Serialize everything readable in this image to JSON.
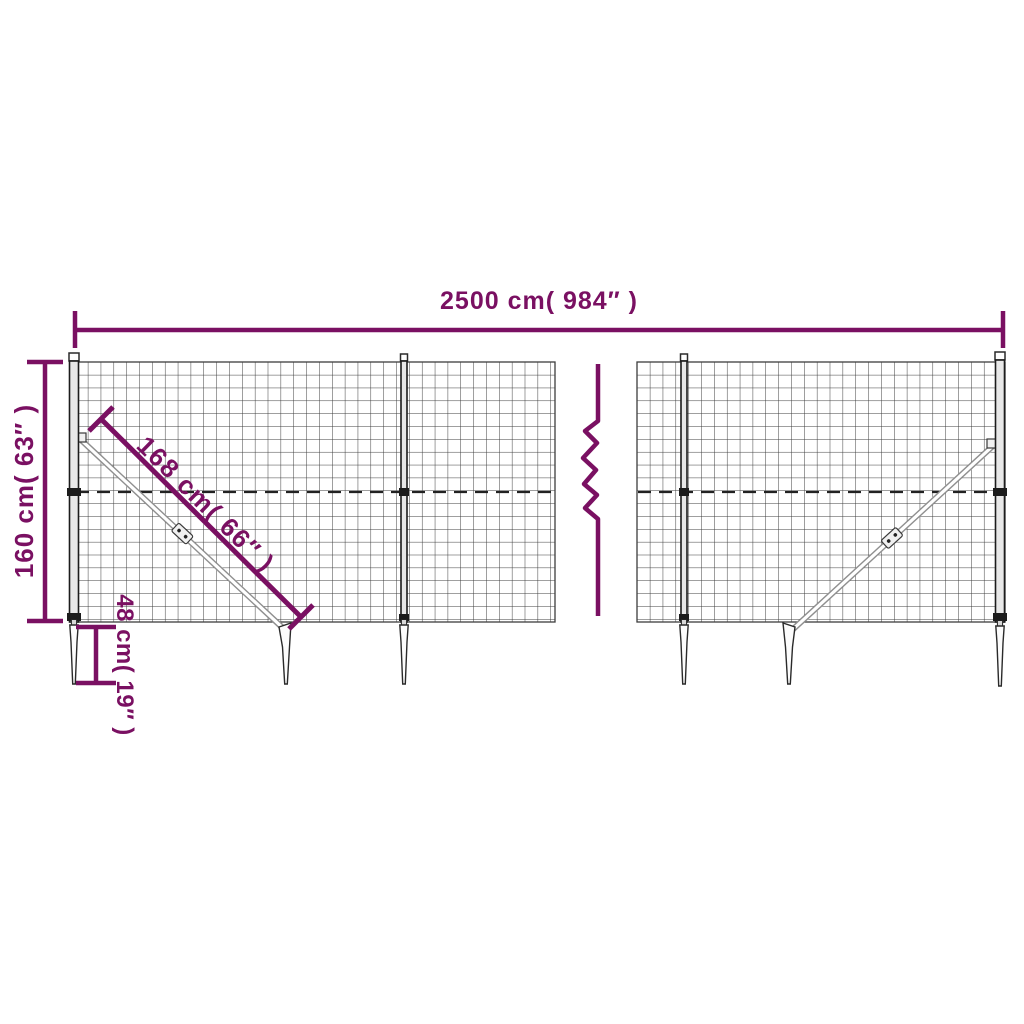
{
  "diagram": {
    "title": "Wire mesh fence with ground anchor spikes - dimension diagram",
    "labels": {
      "total_width": "2500 cm( 984″ )",
      "height": "160 cm( 63″ )",
      "brace_length": "168 cm( 66″ )",
      "spike_depth": "48 cm( 19″ )"
    },
    "colors": {
      "accent": "#7a1062",
      "wire": "#3d3d3d",
      "background": "#ffffff"
    }
  }
}
